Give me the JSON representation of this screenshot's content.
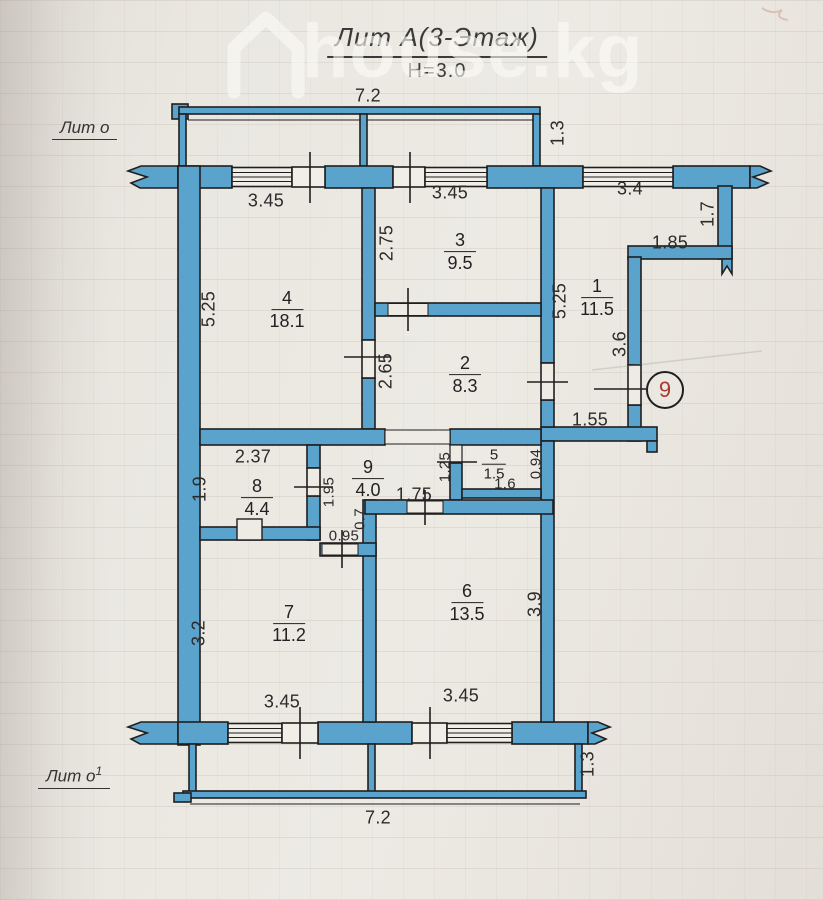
{
  "watermark": {
    "text": "house.kg",
    "icon": "house-icon"
  },
  "title": {
    "main": "Лит А(3-Этаж)",
    "height": "Н=3.0"
  },
  "labels": {
    "balcony_top": "Лит о",
    "balcony_bottom": "Лит о",
    "balcony_bottom_sup": "1"
  },
  "entry": {
    "apartment_number": "9"
  },
  "colors": {
    "wall_fill": "#5aa3cc",
    "wall_outline": "#1f1f1f",
    "dim_text": "#2b2b2b",
    "apartment_number": "#a93a30",
    "paper": "#eae7e1"
  },
  "rooms": {
    "r1": {
      "num": "1",
      "area": "11.5"
    },
    "r2": {
      "num": "2",
      "area": "8.3"
    },
    "r3": {
      "num": "3",
      "area": "9.5"
    },
    "r4": {
      "num": "4",
      "area": "18.1"
    },
    "r5": {
      "num": "5",
      "area": "1.5"
    },
    "r6": {
      "num": "6",
      "area": "13.5"
    },
    "r7": {
      "num": "7",
      "area": "11.2"
    },
    "r8": {
      "num": "8",
      "area": "4.4"
    },
    "r9": {
      "num": "9",
      "area": "4.0"
    }
  },
  "dims": {
    "top_width": "7.2",
    "top_balcony_depth": "1.3",
    "win_top_left": "3.45",
    "win_top_right": "3.45",
    "corr_top": "3.4",
    "step_height": "1.7",
    "step_width": "1.85",
    "room4_height": "5.25",
    "room3_depth": "2.75",
    "room2_depth": "2.65",
    "room1_height": "5.25",
    "entry_wall": "3.6",
    "corr_bottom": "1.55",
    "room8_width": "2.37",
    "room8_depth": "1.9",
    "hall_wall": "1.95",
    "wc_left": "1.25",
    "wc_right": "0.94",
    "wc_width": "1.6",
    "room6_door": "1.75",
    "small_wall": "0.7",
    "room7_door": "0.95",
    "room7_height": "3.2",
    "room6_height": "3.9",
    "win_bottom_left": "3.45",
    "win_bottom_right": "3.45",
    "bottom_width": "7.2",
    "bottom_balcony_depth": "1.3"
  }
}
